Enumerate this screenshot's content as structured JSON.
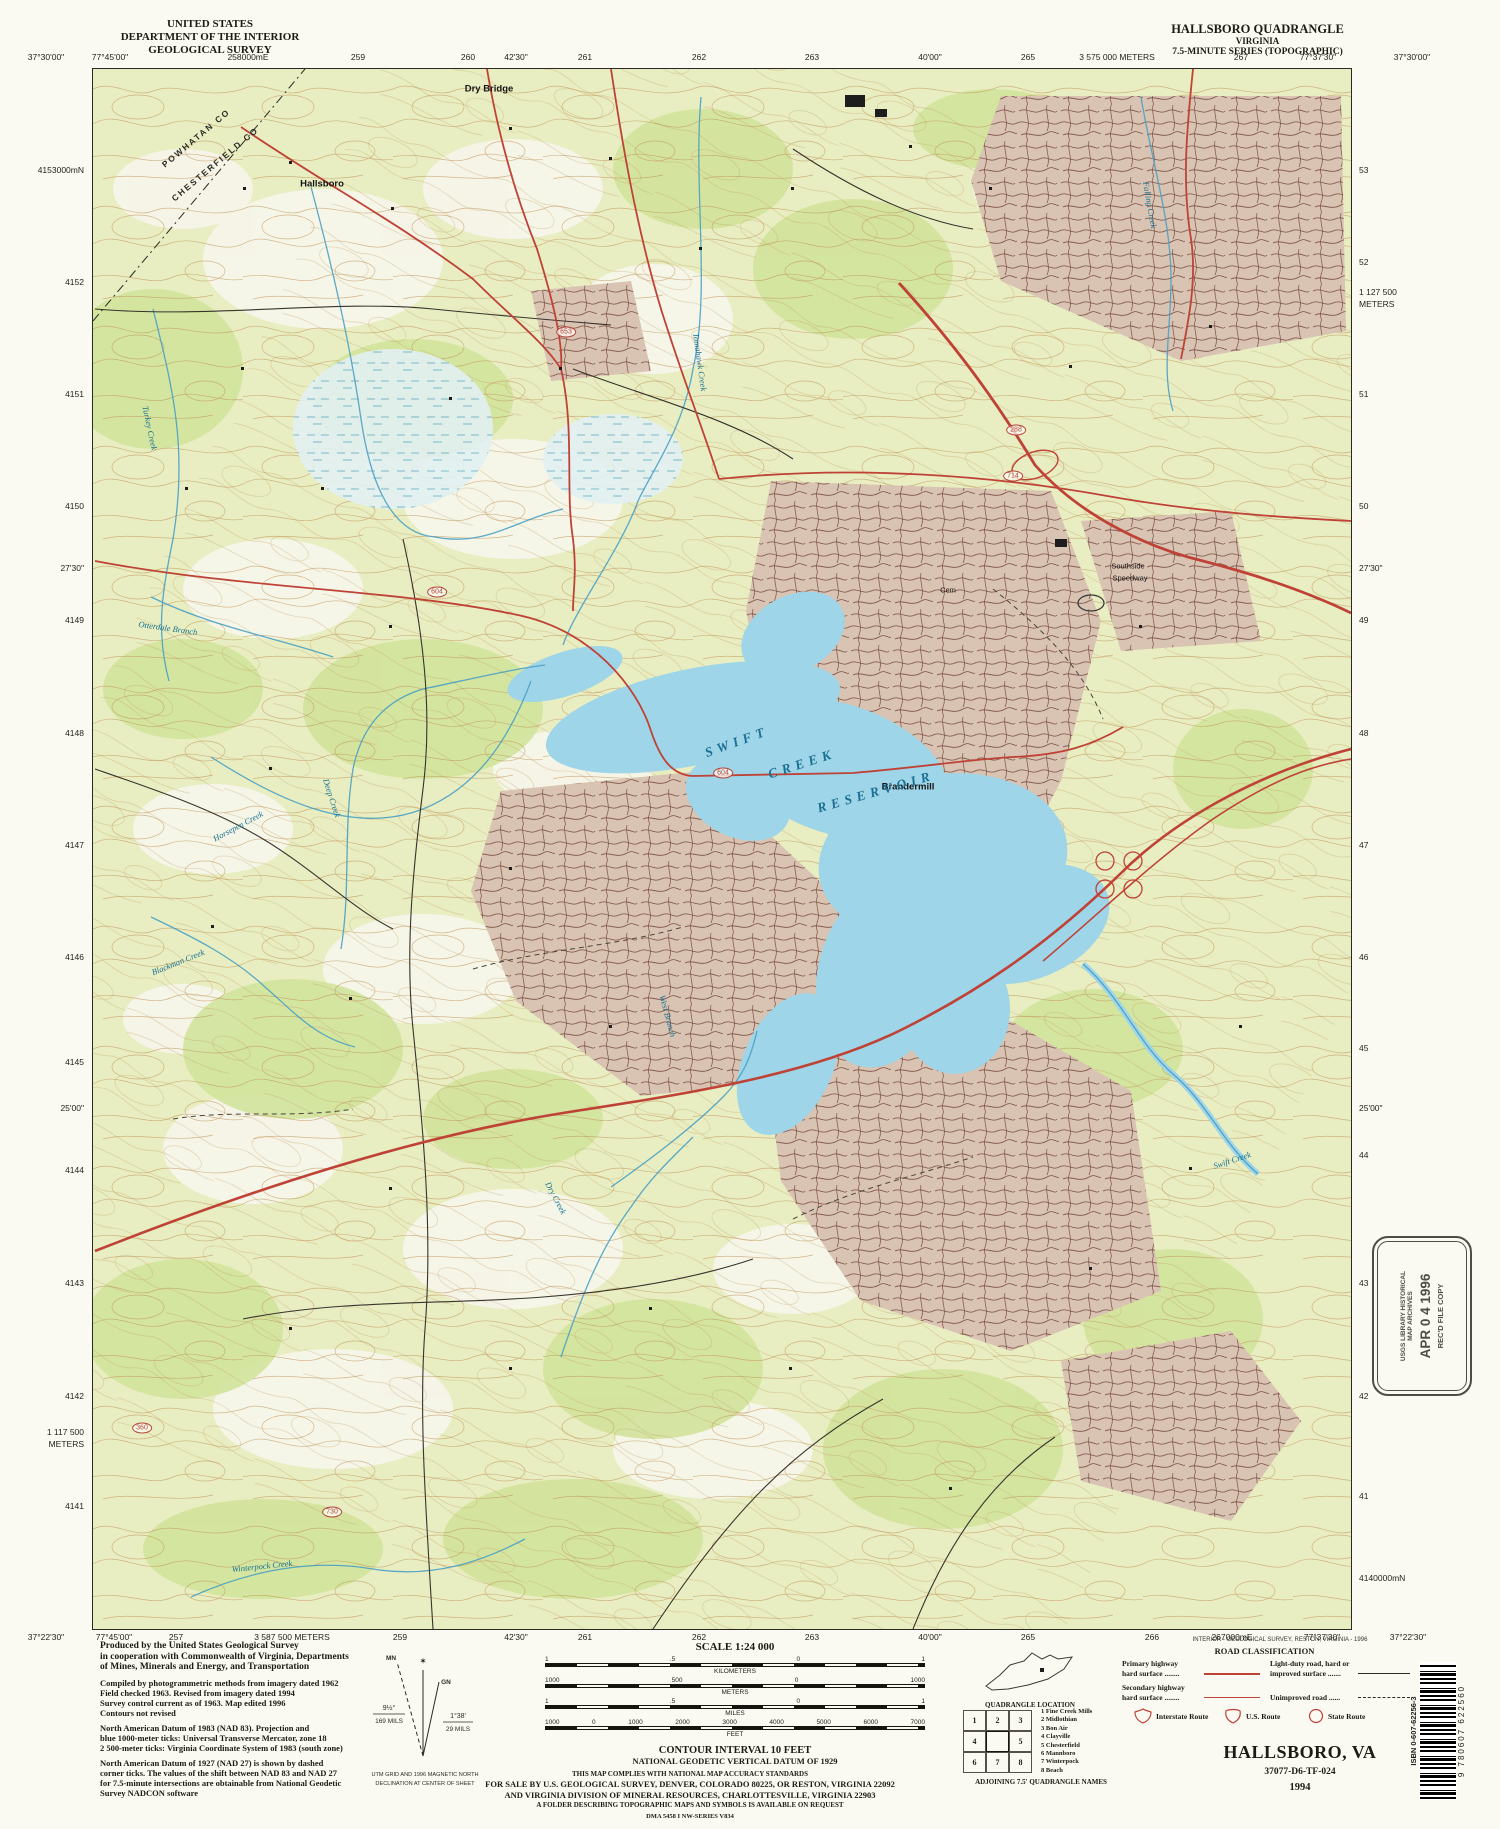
{
  "header": {
    "us": "UNITED STATES",
    "dept": "DEPARTMENT OF THE INTERIOR",
    "survey": "GEOLOGICAL SURVEY",
    "quad": "HALLSBORO QUADRANGLE",
    "state": "VIRGINIA",
    "series": "7.5-MINUTE SERIES (TOPOGRAPHIC)"
  },
  "colors": {
    "water": "#9fd5e9",
    "forest": "#d2e39c",
    "urban": "#d9c3b3",
    "road_primary": "#bf4236",
    "contour": "#bd8c4e"
  },
  "collar": {
    "top": [
      {
        "t": "37°30'00\"",
        "x": 46
      },
      {
        "t": "77°45'00\"",
        "x": 110
      },
      {
        "t": "258000mE",
        "x": 248
      },
      {
        "t": "259",
        "x": 358
      },
      {
        "t": "260",
        "x": 468
      },
      {
        "t": "42'30\"",
        "x": 516
      },
      {
        "t": "261",
        "x": 585
      },
      {
        "t": "262",
        "x": 699
      },
      {
        "t": "263",
        "x": 812
      },
      {
        "t": "40'00\"",
        "x": 930
      },
      {
        "t": "265",
        "x": 1028
      },
      {
        "t": "3 575 000 METERS",
        "x": 1117
      },
      {
        "t": "267",
        "x": 1241
      },
      {
        "t": "77°37'30\"",
        "x": 1318
      },
      {
        "t": "37°30'00\"",
        "x": 1412
      }
    ],
    "bottom": [
      {
        "t": "37°22'30\"",
        "x": 46
      },
      {
        "t": "77°45'00\"",
        "x": 114
      },
      {
        "t": "257",
        "x": 176
      },
      {
        "t": "3 587 500 METERS",
        "x": 292
      },
      {
        "t": "259",
        "x": 400
      },
      {
        "t": "42'30\"",
        "x": 516
      },
      {
        "t": "261",
        "x": 585
      },
      {
        "t": "262",
        "x": 699
      },
      {
        "t": "263",
        "x": 812
      },
      {
        "t": "40'00\"",
        "x": 930
      },
      {
        "t": "265",
        "x": 1028
      },
      {
        "t": "266",
        "x": 1152
      },
      {
        "t": "267000mE",
        "x": 1232
      },
      {
        "t": "77°37'30\"",
        "x": 1322
      },
      {
        "t": "37°22'30\"",
        "x": 1408
      }
    ],
    "left": [
      {
        "t": "4153000mN",
        "y": 170
      },
      {
        "t": "4152",
        "y": 282
      },
      {
        "t": "4151",
        "y": 394
      },
      {
        "t": "4150",
        "y": 506
      },
      {
        "t": "27'30\"",
        "y": 568
      },
      {
        "t": "4149",
        "y": 620
      },
      {
        "t": "4148",
        "y": 733
      },
      {
        "t": "4147",
        "y": 845
      },
      {
        "t": "4146",
        "y": 957
      },
      {
        "t": "4145",
        "y": 1062
      },
      {
        "t": "25'00\"",
        "y": 1108
      },
      {
        "t": "4144",
        "y": 1170
      },
      {
        "t": "4143",
        "y": 1283
      },
      {
        "t": "4142",
        "y": 1396
      },
      {
        "t": "1 117 500",
        "y": 1432
      },
      {
        "t": "METERS",
        "y": 1444
      },
      {
        "t": "4141",
        "y": 1506
      }
    ],
    "right": [
      {
        "t": "53",
        "y": 170
      },
      {
        "t": "52",
        "y": 262
      },
      {
        "t": "1 127 500",
        "y": 292
      },
      {
        "t": "METERS",
        "y": 304
      },
      {
        "t": "51",
        "y": 394
      },
      {
        "t": "50",
        "y": 506
      },
      {
        "t": "27'30\"",
        "y": 568
      },
      {
        "t": "49",
        "y": 620
      },
      {
        "t": "48",
        "y": 733
      },
      {
        "t": "47",
        "y": 845
      },
      {
        "t": "46",
        "y": 957
      },
      {
        "t": "45",
        "y": 1048
      },
      {
        "t": "25'00\"",
        "y": 1108
      },
      {
        "t": "44",
        "y": 1155
      },
      {
        "t": "43",
        "y": 1283
      },
      {
        "t": "42",
        "y": 1396
      },
      {
        "t": "41",
        "y": 1496
      },
      {
        "t": "4140000mN",
        "y": 1578
      }
    ]
  },
  "map": {
    "labels": [
      {
        "t": "POWHATAN CO",
        "x": 196,
        "y": 138,
        "r": -40,
        "k": "county"
      },
      {
        "t": "CHESTERFIELD CO",
        "x": 215,
        "y": 164,
        "r": -40,
        "k": "county"
      },
      {
        "t": "Hallsboro",
        "x": 322,
        "y": 184,
        "r": 0,
        "k": "place"
      },
      {
        "t": "Dry Bridge",
        "x": 489,
        "y": 89,
        "r": 0,
        "k": "place"
      },
      {
        "t": "Southside",
        "x": 1128,
        "y": 566,
        "r": 0,
        "k": "place-sm"
      },
      {
        "t": "Speedway",
        "x": 1130,
        "y": 578,
        "r": 0,
        "k": "place-sm"
      },
      {
        "t": "Cem",
        "x": 948,
        "y": 590,
        "r": 0,
        "k": "place-sm"
      },
      {
        "t": "Brandermill",
        "x": 908,
        "y": 787,
        "r": 0,
        "k": "place"
      },
      {
        "t": "SWIFT",
        "x": 737,
        "y": 742,
        "r": -20,
        "k": "water-big"
      },
      {
        "t": "CREEK",
        "x": 802,
        "y": 764,
        "r": -18,
        "k": "water-big"
      },
      {
        "t": "RESERVOIR",
        "x": 876,
        "y": 792,
        "r": -16,
        "k": "water-big"
      },
      {
        "t": "Swift Creek",
        "x": 1232,
        "y": 1160,
        "r": -18,
        "k": "water"
      },
      {
        "t": "Turkey Creek",
        "x": 150,
        "y": 428,
        "r": 78,
        "k": "water"
      },
      {
        "t": "Tomahawk Creek",
        "x": 700,
        "y": 362,
        "r": 82,
        "k": "water"
      },
      {
        "t": "Otterdale Branch",
        "x": 168,
        "y": 628,
        "r": 8,
        "k": "water"
      },
      {
        "t": "Deep Creek",
        "x": 332,
        "y": 798,
        "r": 72,
        "k": "water"
      },
      {
        "t": "Horsepen Creek",
        "x": 238,
        "y": 826,
        "r": -28,
        "k": "water"
      },
      {
        "t": "Blackman Creek",
        "x": 178,
        "y": 962,
        "r": -22,
        "k": "water"
      },
      {
        "t": "West Branch",
        "x": 668,
        "y": 1016,
        "r": 75,
        "k": "water"
      },
      {
        "t": "Dry Creek",
        "x": 556,
        "y": 1198,
        "r": 62,
        "k": "water"
      },
      {
        "t": "Winterpock Creek",
        "x": 262,
        "y": 1566,
        "r": -6,
        "k": "water"
      },
      {
        "t": "Falling Creek",
        "x": 1150,
        "y": 205,
        "r": 80,
        "k": "water"
      },
      {
        "t": "604",
        "x": 723,
        "y": 773,
        "r": 0,
        "k": "shield"
      },
      {
        "t": "604",
        "x": 437,
        "y": 592,
        "r": 0,
        "k": "shield"
      },
      {
        "t": "653",
        "x": 566,
        "y": 332,
        "r": 0,
        "k": "shield"
      },
      {
        "t": "714",
        "x": 1013,
        "y": 476,
        "r": 0,
        "k": "shield"
      },
      {
        "t": "288",
        "x": 1016,
        "y": 430,
        "r": 0,
        "k": "shield"
      },
      {
        "t": "360",
        "x": 142,
        "y": 1428,
        "r": 0,
        "k": "shield"
      },
      {
        "t": "730",
        "x": 332,
        "y": 1512,
        "r": 0,
        "k": "shield"
      }
    ]
  },
  "footer": {
    "credits": {
      "produced": [
        "Produced by the United States Geological Survey",
        "in cooperation with Commonwealth of Virginia, Departments",
        "of Mines, Minerals and Energy, and Transportation"
      ],
      "compiled": [
        "Compiled by photogrammetric methods from imagery dated 1962",
        "Field checked 1963.  Revised from imagery dated 1994",
        "Survey control current as of 1963.  Map edited 1996",
        "Contours not revised"
      ],
      "datum": [
        "North American Datum of 1983 (NAD 83).  Projection and",
        "blue 1000-meter ticks: Universal Transverse Mercator, zone 18",
        "2 500-meter ticks: Virginia Coordinate System of 1983 (south zone)"
      ],
      "nad27": [
        "North American Datum of 1927 (NAD 27) is shown by dashed",
        "corner ticks.  The values of the shift between NAD 83 and NAD 27",
        "for 7.5-minute intersections are obtainable from National Geodetic",
        "Survey NADCON software"
      ]
    },
    "declination": {
      "mn": "MN",
      "gn": "GN",
      "star": "✶",
      "mn_deg": "9½°",
      "mn_mils": "169 MILS",
      "gn_deg": "1°38'",
      "gn_mils": "29 MILS",
      "cap1": "UTM GRID AND 1996 MAGNETIC NORTH",
      "cap2": "DECLINATION AT CENTER OF SHEET"
    },
    "scale": {
      "title": "SCALE 1:24 000",
      "rows": [
        {
          "unit": "KILOMETERS",
          "ticks": [
            "1",
            ".5",
            "0",
            "1"
          ]
        },
        {
          "unit": "METERS",
          "ticks": [
            "1000",
            "500",
            "0",
            "1000"
          ]
        },
        {
          "unit": "MILES",
          "ticks": [
            "1",
            ".5",
            "0",
            "1"
          ]
        },
        {
          "unit": "FEET",
          "ticks": [
            "1000",
            "0",
            "1000",
            "2000",
            "3000",
            "4000",
            "5000",
            "6000",
            "7000"
          ]
        }
      ]
    },
    "contour1": "CONTOUR INTERVAL 10 FEET",
    "contour2": "NATIONAL GEODETIC VERTICAL DATUM OF 1929",
    "compliance": "THIS MAP COMPLIES WITH NATIONAL MAP ACCURACY STANDARDS",
    "sale1": "FOR SALE BY U.S. GEOLOGICAL SURVEY, DENVER, COLORADO 80225, OR RESTON, VIRGINIA 22092",
    "sale2": "AND VIRGINIA DIVISION OF MINERAL RESOURCES, CHARLOTTESVILLE, VIRGINIA 22903",
    "folder": "A FOLDER DESCRIBING TOPOGRAPHIC MAPS AND SYMBOLS IS AVAILABLE ON REQUEST",
    "dma": "DMA 5458 I NW-SERIES V834",
    "quad_location": "QUADRANGLE LOCATION",
    "adjoining": {
      "caption": "ADJOINING 7.5' QUADRANGLE NAMES",
      "cells": [
        "1",
        "2",
        "3",
        "4",
        "",
        "5",
        "6",
        "7",
        "8"
      ],
      "names": [
        "1 Fine Creek Mills",
        "2 Midlothian",
        "3 Bon Air",
        "4 Clayville",
        "5 Chesterfield",
        "6 Mannboro",
        "7 Winterpock",
        "8 Beach"
      ]
    },
    "road_class": {
      "title": "ROAD CLASSIFICATION",
      "primary1": "Primary highway",
      "primary2": "hard surface ........",
      "secondary1": "Secondary highway",
      "secondary2": "hard surface ........",
      "light1": "Light-duty road, hard or",
      "light2": "improved surface .......",
      "unimproved": "Unimproved road ......",
      "interstate": "Interstate Route",
      "us_route": "U.S. Route",
      "state_route": "State Route"
    },
    "interior": "INTERIOR - GEOLOGICAL SURVEY, RESTON, VIRGINIA - 1996",
    "title_block": {
      "name": "HALLSBORO, VA",
      "id": "37077-D6-TF-024",
      "year": "1994"
    }
  },
  "stamp": {
    "l1": "USGS LIBRARY HISTORICAL",
    "l2": "MAP ARCHIVES",
    "date": "APR 0 4 1996",
    "l3": "REC'D FILE COPY"
  },
  "barcode": {
    "isbn": "ISBN 0-607-62256-3",
    "digits": "9 780607 622560"
  }
}
